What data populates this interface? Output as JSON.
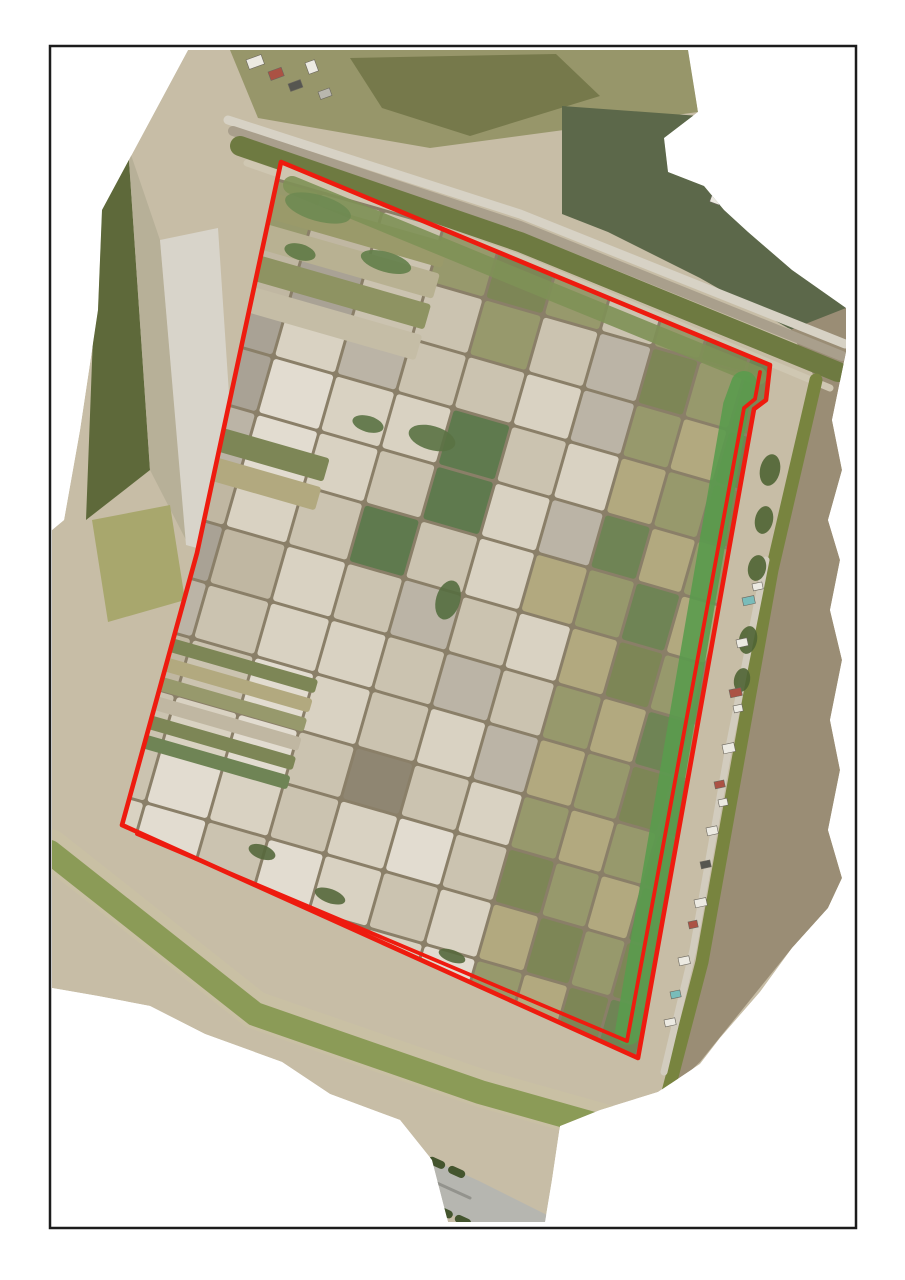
{
  "page": {
    "background": "#ffffff",
    "width": 905,
    "height": 1280
  },
  "frame": {
    "x": 50,
    "y": 46,
    "width": 806,
    "height": 1182,
    "stroke": "#1c1c1c",
    "stroke_width": 2.5,
    "fill": "#ffffff"
  },
  "ortho": {
    "base_fill": "#c7bda6",
    "outline_points": "188,50 688,50 698,112 664,138 668,172 704,186 724,210 748,232 792,270 846,308 846,352 832,420 842,470 828,520 840,560 830,610 842,660 830,720 840,770 828,830 842,878 828,908 792,948 760,992 720,1038 700,1064 658,1092 600,1110 560,1126 552,1180 545,1222 448,1222 432,1160 400,1120 330,1094 282,1062 205,1034 150,1006 98,996 52,988 52,530 64,520 80,430 98,310 102,210"
  },
  "boundary": {
    "color": "#ee1b0f",
    "outer_width": 4.6,
    "inner_width": 3.8,
    "outer_points": "281,162 770,365 766,400 754,409 638,1058 122,825 197,553",
    "inner_points": "760,372 755,399 744,408 627,1041 137,834",
    "interior_fill": "#cfc5b0"
  },
  "regions": [
    {
      "name": "top-field-olive",
      "points": "230,50 690,50 698,112 430,148 258,118",
      "fill": "#97966a"
    },
    {
      "name": "top-wet-dark",
      "points": "350,58 556,54 600,96 470,136 382,108",
      "fill": "#76794b"
    },
    {
      "name": "top-plateau-sage",
      "points": "562,106 700,116 738,168 802,238 846,308 846,352 788,328 700,278 608,232 562,214",
      "fill": "#5c684a"
    },
    {
      "name": "right-rough-ground",
      "points": "846,308 846,352 832,420 842,470 828,520 840,560 830,610 842,660 830,720 840,770 828,830 842,878 828,908 792,948 700,1062 668,1092 700,962 737,766 772,570 816,380 790,330",
      "fill": "#9a8d75"
    },
    {
      "name": "left-strip-dark",
      "points": "100,152 128,146 150,470 86,520",
      "fill": "#5e693a"
    },
    {
      "name": "left-strip-tan",
      "points": "128,146 160,240 186,540 150,470",
      "fill": "#b7b098"
    },
    {
      "name": "left-strip-pale",
      "points": "160,240 218,228 240,560 186,545",
      "fill": "#d8d4ca"
    },
    {
      "name": "left-pond-khaki",
      "points": "92,520 170,505 185,600 108,622",
      "fill": "#a8a76d"
    }
  ],
  "waterways": [
    {
      "name": "top-road-outer",
      "d": "M228,120 L520,214 L845,344",
      "stroke": "#d7d2c5",
      "width": 9
    },
    {
      "name": "top-band-gray",
      "d": "M233,131 L520,226 L842,356",
      "stroke": "#a99f8c",
      "width": 10
    },
    {
      "name": "top-canal",
      "d": "M240,146 L520,242 L838,372",
      "stroke": "#6e7a41",
      "width": 20
    },
    {
      "name": "top-levee-light",
      "d": "M247,163 L520,258 L830,388",
      "stroke": "#cfc7b2",
      "width": 7
    },
    {
      "name": "right-canal",
      "d": "M816,380 L772,570 L737,766 L702,962 L668,1092",
      "stroke": "#78843f",
      "width": 13
    },
    {
      "name": "village-road",
      "d": "M766,560 L728,752 L693,950 L664,1072",
      "stroke": "#d2ccbe",
      "width": 7
    },
    {
      "name": "bottom-canal-bank",
      "d": "M50,848 L255,1010 L480,1088 L700,1150",
      "stroke": "#c9c0a4",
      "width": 38
    },
    {
      "name": "bottom-canal",
      "d": "M50,852 L255,1014 L480,1092 L700,1154",
      "stroke": "#8b9b57",
      "width": 24
    },
    {
      "name": "highway-base",
      "d": "M52,1018 L250,1100 L470,1200 L560,1245",
      "stroke": "#b6b6b0",
      "width": 42
    },
    {
      "name": "highway-median",
      "d": "M52,1016 L250,1098 L470,1198",
      "stroke": "#93938d",
      "width": 3
    },
    {
      "name": "highway-tree-row-upper",
      "d": "M48,996 L250,1078 L470,1178",
      "stroke": "#44552e",
      "width": 8,
      "dash": "10 12"
    },
    {
      "name": "highway-tree-row-lower",
      "d": "M56,1042 L250,1124 L470,1224",
      "stroke": "#44552e",
      "width": 8,
      "dash": "9 11"
    },
    {
      "name": "cross-road",
      "d": "M78,1098 L195,1240",
      "stroke": "#cac6bc",
      "width": 9
    }
  ],
  "inner_bands": [
    {
      "name": "inner-green-top",
      "d": "M292,185 L540,287 L758,376",
      "stroke": "#7e9156",
      "width": 18,
      "opacity": 0.9
    },
    {
      "name": "inner-green-right",
      "d": "M744,384 L736,406 L628,1032",
      "stroke": "#5a9b4e",
      "width": 26,
      "opacity": 0.9
    }
  ],
  "grid": {
    "origin": [
      255,
      175
    ],
    "angle": 16,
    "gap": 3,
    "dike_color": "#8a7f68",
    "col_widths": [
      66,
      62,
      60,
      56,
      58,
      56,
      52,
      46,
      44,
      40,
      38
    ],
    "row_heights": [
      54,
      56,
      52,
      56,
      54,
      58,
      56,
      54,
      56,
      52,
      54,
      56,
      52
    ],
    "palette": {
      "cream": "#d9d2c2",
      "beige": "#cbc3b0",
      "tan": "#c0b7a2",
      "gray": "#a9a295",
      "lgray": "#bbb4a6",
      "olv": "#97996c",
      "dolv": "#7d8656",
      "grn": "#6f8455",
      "dgrn": "#5f7a4e",
      "khaki": "#b2a97f",
      "pale": "#e2dcd0",
      "mud": "#8f8672"
    },
    "cells": [
      [
        "olv",
        "tan",
        "beige",
        "olv",
        "dolv",
        "olv",
        "beige",
        "olv",
        "dolv",
        "grn",
        "dolv"
      ],
      [
        "tan",
        "gray",
        "beige",
        "beige",
        "olv",
        "beige",
        "lgray",
        "dolv",
        "olv",
        "dolv",
        "grn"
      ],
      [
        "gray",
        "cream",
        "lgray",
        "beige",
        "beige",
        "cream",
        "lgray",
        "olv",
        "khaki",
        "grn",
        "dolv"
      ],
      [
        "gray",
        "pale",
        "cream",
        "cream",
        "dgrn",
        "beige",
        "cream",
        "khaki",
        "olv",
        "dolv",
        "grn"
      ],
      [
        "lgray",
        "pale",
        "cream",
        "beige",
        "dgrn",
        "cream",
        "lgray",
        "grn",
        "khaki",
        "olv",
        "dolv"
      ],
      [
        "tan",
        "cream",
        "beige",
        "dgrn",
        "beige",
        "cream",
        "khaki",
        "olv",
        "grn",
        "khaki",
        "grn"
      ],
      [
        "gray",
        "tan",
        "cream",
        "beige",
        "lgray",
        "beige",
        "cream",
        "khaki",
        "dolv",
        "olv",
        "dolv"
      ],
      [
        "lgray",
        "beige",
        "cream",
        "cream",
        "beige",
        "lgray",
        "beige",
        "olv",
        "khaki",
        "grn",
        "olv"
      ],
      [
        "tan",
        "beige",
        "pale",
        "cream",
        "beige",
        "cream",
        "lgray",
        "khaki",
        "olv",
        "dolv",
        "grn"
      ],
      [
        "beige",
        "cream",
        "pale",
        "beige",
        "mud",
        "beige",
        "cream",
        "olv",
        "khaki",
        "olv",
        "dolv"
      ],
      [
        "beige",
        "pale",
        "cream",
        "beige",
        "cream",
        "pale",
        "beige",
        "dolv",
        "olv",
        "khaki",
        "grn"
      ],
      [
        "cream",
        "pale",
        "beige",
        "pale",
        "cream",
        "beige",
        "cream",
        "khaki",
        "dolv",
        "olv",
        "dolv"
      ],
      [
        "pale",
        "cream",
        "pale",
        "cream",
        "beige",
        "cream",
        "pale",
        "olv",
        "khaki",
        "dolv",
        "grn"
      ]
    ]
  },
  "strips": [
    {
      "x": 10,
      "y": 12,
      "w": 195,
      "h": 26,
      "color": "#9a9a6a"
    },
    {
      "x": 10,
      "y": 44,
      "w": 195,
      "h": 26,
      "color": "#b8b192"
    },
    {
      "x": 10,
      "y": 76,
      "w": 195,
      "h": 26,
      "color": "#8e9362"
    },
    {
      "x": 10,
      "y": 108,
      "w": 195,
      "h": 26,
      "color": "#c5bda6"
    },
    {
      "x": 0,
      "y": 252,
      "w": 150,
      "h": 24,
      "color": "#7d8656"
    },
    {
      "x": 0,
      "y": 282,
      "w": 150,
      "h": 24,
      "color": "#b2a97f"
    },
    {
      "x": 28,
      "y": 468,
      "w": 172,
      "h": 14,
      "color": "#7d8656"
    },
    {
      "x": 28,
      "y": 488,
      "w": 172,
      "h": 14,
      "color": "#b2a97f"
    },
    {
      "x": 28,
      "y": 508,
      "w": 172,
      "h": 14,
      "color": "#97996c"
    },
    {
      "x": 28,
      "y": 528,
      "w": 172,
      "h": 14,
      "color": "#c0b7a2"
    },
    {
      "x": 28,
      "y": 548,
      "w": 172,
      "h": 14,
      "color": "#7d8656"
    },
    {
      "x": 28,
      "y": 568,
      "w": 172,
      "h": 14,
      "color": "#6f8455"
    }
  ],
  "vegetation": [
    {
      "cx": 318,
      "cy": 208,
      "rx": 34,
      "ry": 13,
      "rot": 16,
      "fill": "#6e8a52"
    },
    {
      "cx": 386,
      "cy": 262,
      "rx": 26,
      "ry": 10,
      "rot": 16,
      "fill": "#63804a"
    },
    {
      "cx": 300,
      "cy": 252,
      "rx": 16,
      "ry": 8,
      "rot": 16,
      "fill": "#5f7a46"
    },
    {
      "cx": 432,
      "cy": 438,
      "rx": 24,
      "ry": 12,
      "rot": 16,
      "fill": "#5a7244"
    },
    {
      "cx": 368,
      "cy": 424,
      "rx": 16,
      "ry": 8,
      "rot": 16,
      "fill": "#5a7244"
    },
    {
      "cx": 448,
      "cy": 600,
      "rx": 12,
      "ry": 20,
      "rot": 16,
      "fill": "#556e40"
    },
    {
      "cx": 262,
      "cy": 852,
      "rx": 14,
      "ry": 7,
      "rot": 20,
      "fill": "#55683c"
    },
    {
      "cx": 330,
      "cy": 896,
      "rx": 16,
      "ry": 7,
      "rot": 20,
      "fill": "#55683c"
    },
    {
      "cx": 452,
      "cy": 956,
      "rx": 14,
      "ry": 6,
      "rot": 20,
      "fill": "#55683c"
    },
    {
      "cx": 770,
      "cy": 470,
      "rx": 10,
      "ry": 16,
      "rot": 12,
      "fill": "#4f6434"
    },
    {
      "cx": 764,
      "cy": 520,
      "rx": 9,
      "ry": 14,
      "rot": 12,
      "fill": "#4f6434"
    },
    {
      "cx": 757,
      "cy": 568,
      "rx": 9,
      "ry": 13,
      "rot": 12,
      "fill": "#4f6434"
    },
    {
      "cx": 748,
      "cy": 640,
      "rx": 9,
      "ry": 14,
      "rot": 12,
      "fill": "#4f6434"
    },
    {
      "cx": 742,
      "cy": 680,
      "rx": 8,
      "ry": 12,
      "rot": 12,
      "fill": "#4f6434"
    }
  ],
  "building_colors": {
    "white": "#eceae2",
    "red": "#ab5244",
    "teal": "#79bcba",
    "dark": "#565650",
    "gray": "#b9b7ae"
  },
  "buildings": [
    [
      246,
      60,
      16,
      10,
      -20,
      "white"
    ],
    [
      268,
      72,
      14,
      9,
      -20,
      "red"
    ],
    [
      288,
      84,
      13,
      8,
      -20,
      "dark"
    ],
    [
      305,
      63,
      10,
      12,
      -20,
      "white"
    ],
    [
      318,
      92,
      12,
      8,
      -20,
      "gray"
    ],
    [
      712,
      195,
      10,
      7,
      20,
      "white"
    ],
    [
      742,
      598,
      12,
      8,
      -12,
      "teal"
    ],
    [
      752,
      584,
      10,
      7,
      -12,
      "white"
    ],
    [
      736,
      640,
      11,
      8,
      -12,
      "white"
    ],
    [
      729,
      690,
      12,
      8,
      -12,
      "red"
    ],
    [
      733,
      706,
      9,
      7,
      -12,
      "white"
    ],
    [
      722,
      745,
      12,
      9,
      -12,
      "white"
    ],
    [
      714,
      782,
      10,
      7,
      -12,
      "red"
    ],
    [
      718,
      800,
      9,
      7,
      -12,
      "white"
    ],
    [
      706,
      828,
      11,
      8,
      -12,
      "white"
    ],
    [
      700,
      862,
      10,
      7,
      -12,
      "dark"
    ],
    [
      694,
      900,
      12,
      8,
      -12,
      "white"
    ],
    [
      688,
      922,
      9,
      7,
      -12,
      "red"
    ],
    [
      678,
      958,
      11,
      8,
      -12,
      "white"
    ],
    [
      670,
      992,
      10,
      7,
      -12,
      "teal"
    ],
    [
      664,
      1020,
      11,
      7,
      -12,
      "white"
    ],
    [
      688,
      1080,
      10,
      7,
      -12,
      "white"
    ]
  ],
  "vehicles": [
    [
      210,
      1092,
      9,
      4,
      23,
      "#3f66a8"
    ],
    [
      300,
      1130,
      8,
      4,
      23,
      "#ffffff"
    ],
    [
      380,
      1168,
      9,
      4,
      23,
      "#2e2e2e"
    ]
  ]
}
